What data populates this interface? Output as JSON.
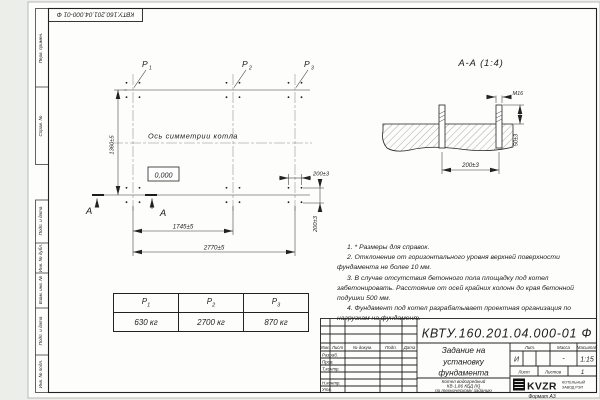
{
  "stamp_margin": {
    "doc_number_top": "КВТУ.160.201.04.000-01  Ф",
    "fields": [
      "Перв. примен.",
      "Справ. №",
      "Подп. и дата",
      "Инв. № дубл.",
      "Взам. инв. №",
      "Подп. и дата",
      "Инв. № подл."
    ]
  },
  "plan": {
    "point_labels": [
      {
        "base": "P",
        "sub": "1"
      },
      {
        "base": "P",
        "sub": "2"
      },
      {
        "base": "P",
        "sub": "3"
      }
    ],
    "symmetry_axis_label": "Ось симметрии котла",
    "level_mark": "0,000",
    "section_letter": "А",
    "dims": {
      "height": "1360±5",
      "span_mid": "1745±5",
      "span_total": "2770±5",
      "bolt_spacing_h": "200±3",
      "bolt_spacing_v": "200±3"
    }
  },
  "section_view": {
    "title": "А-А (1:4)",
    "thread_label": "M16",
    "dims": {
      "bolt_spacing": "200±3",
      "protrusion": "50±3"
    }
  },
  "notes": {
    "items": [
      "1. * Размеры для справок.",
      "2. Отклонение от горизонтального уровня верхней поверхности фундамента не более 10 мм.",
      "3. В случае отсутствия бетонного пола площадку под котел забетонировать. Расстояние от осей крайних колонн до края бетонной подушки 500 мм.",
      "4. Фундамент под котел разрабатывает проектная организация по нагрузкам на фундамент."
    ]
  },
  "loads_table": {
    "headers": [
      {
        "base": "P",
        "sub": "1"
      },
      {
        "base": "P",
        "sub": "2"
      },
      {
        "base": "P",
        "sub": "3"
      }
    ],
    "values": [
      "630 кг",
      "2700 кг",
      "870 кг"
    ]
  },
  "title_block": {
    "doc_number": "КВТУ.160.201.04.000-01 Ф",
    "title_lines": [
      "Задание на",
      "установку",
      "фундамента"
    ],
    "product_lines": [
      "Котел водогрейный",
      "КВ-1,86 КБД (К)",
      "по техническому заданию"
    ],
    "cols": [
      "Изм.",
      "Лист",
      "№ докум.",
      "Подп.",
      "Дата"
    ],
    "rows": [
      "Разраб.",
      "Пров.",
      "Т.контр.",
      "Н.контр.",
      "Утв."
    ],
    "lit_header": "Лит.",
    "lit_value": "И",
    "mass_header": "Масса",
    "mass_value": "-",
    "scale_header": "Масштаб",
    "scale_value": "1:15",
    "sheet_header": "Лист",
    "sheets_header": "Листов",
    "sheets_value": "1",
    "logo": "KVZR",
    "company_lines": [
      "КОТЕЛЬНЫЙ",
      "ЗАВОД РЭП"
    ],
    "format_label": "Формат А3"
  }
}
